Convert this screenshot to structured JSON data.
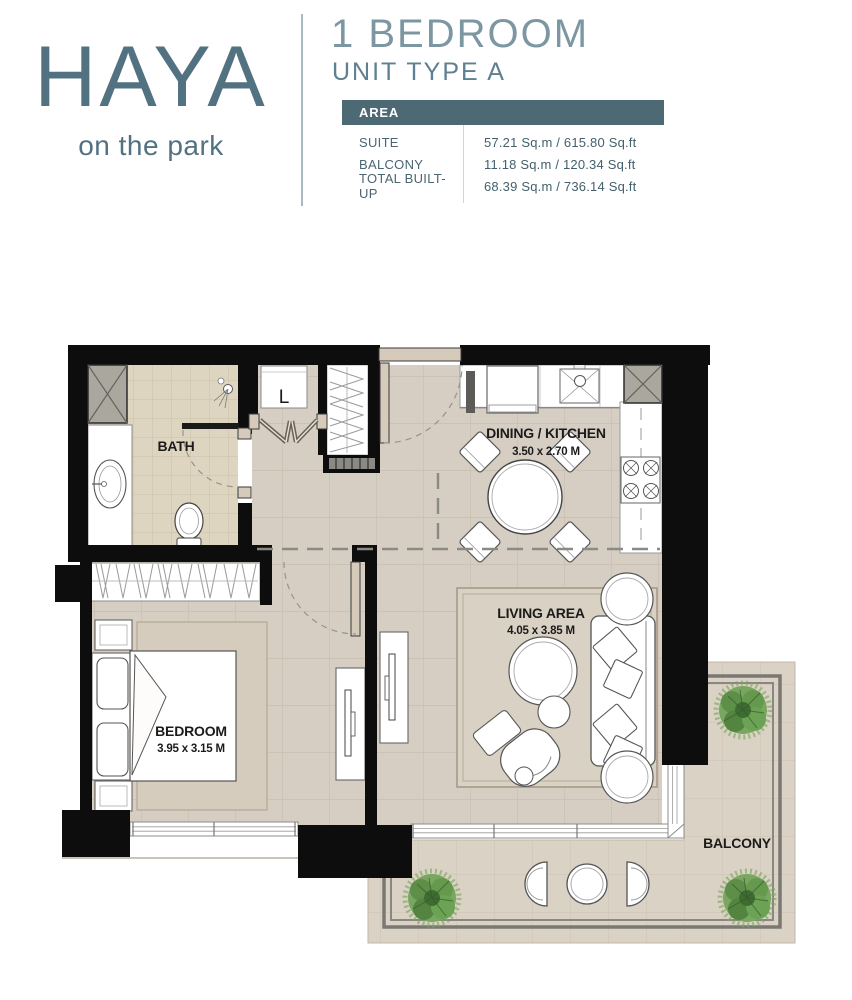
{
  "brand": {
    "name": "HAYA",
    "tagline": "on the park"
  },
  "header": {
    "title": "1 BEDROOM",
    "subtitle": "UNIT TYPE A"
  },
  "area_table": {
    "header_label": "AREA",
    "rows": [
      {
        "label": "SUITE",
        "value": "57.21 Sq.m / 615.80 Sq.ft"
      },
      {
        "label": "BALCONY",
        "value": "11.18 Sq.m / 120.34 Sq.ft"
      },
      {
        "label": "TOTAL BUILT-UP",
        "value": "68.39 Sq.m / 736.14 Sq.ft"
      }
    ]
  },
  "plan": {
    "rooms": {
      "bath": {
        "label": "BATH"
      },
      "laundry": {
        "label": "L"
      },
      "dining_kitchen": {
        "label": "DINING / KITCHEN",
        "dimensions": "3.50 x 2.70 M"
      },
      "living": {
        "label": "LIVING AREA",
        "dimensions": "4.05 x 3.85 M"
      },
      "bedroom": {
        "label": "BEDROOM",
        "dimensions": "3.95 x 3.15 M"
      },
      "balcony": {
        "label": "BALCONY"
      }
    }
  },
  "colors": {
    "brand_teal": "#527181",
    "table_header_bg": "#4d6974",
    "wall_black": "#0d0d0d",
    "floor_beige": "#d7cec3",
    "bath_tile": "#ded5c1",
    "balcony_floor": "#dbd2c6",
    "railing_gray": "#7b7874",
    "plant_green": "#5d8f49"
  }
}
